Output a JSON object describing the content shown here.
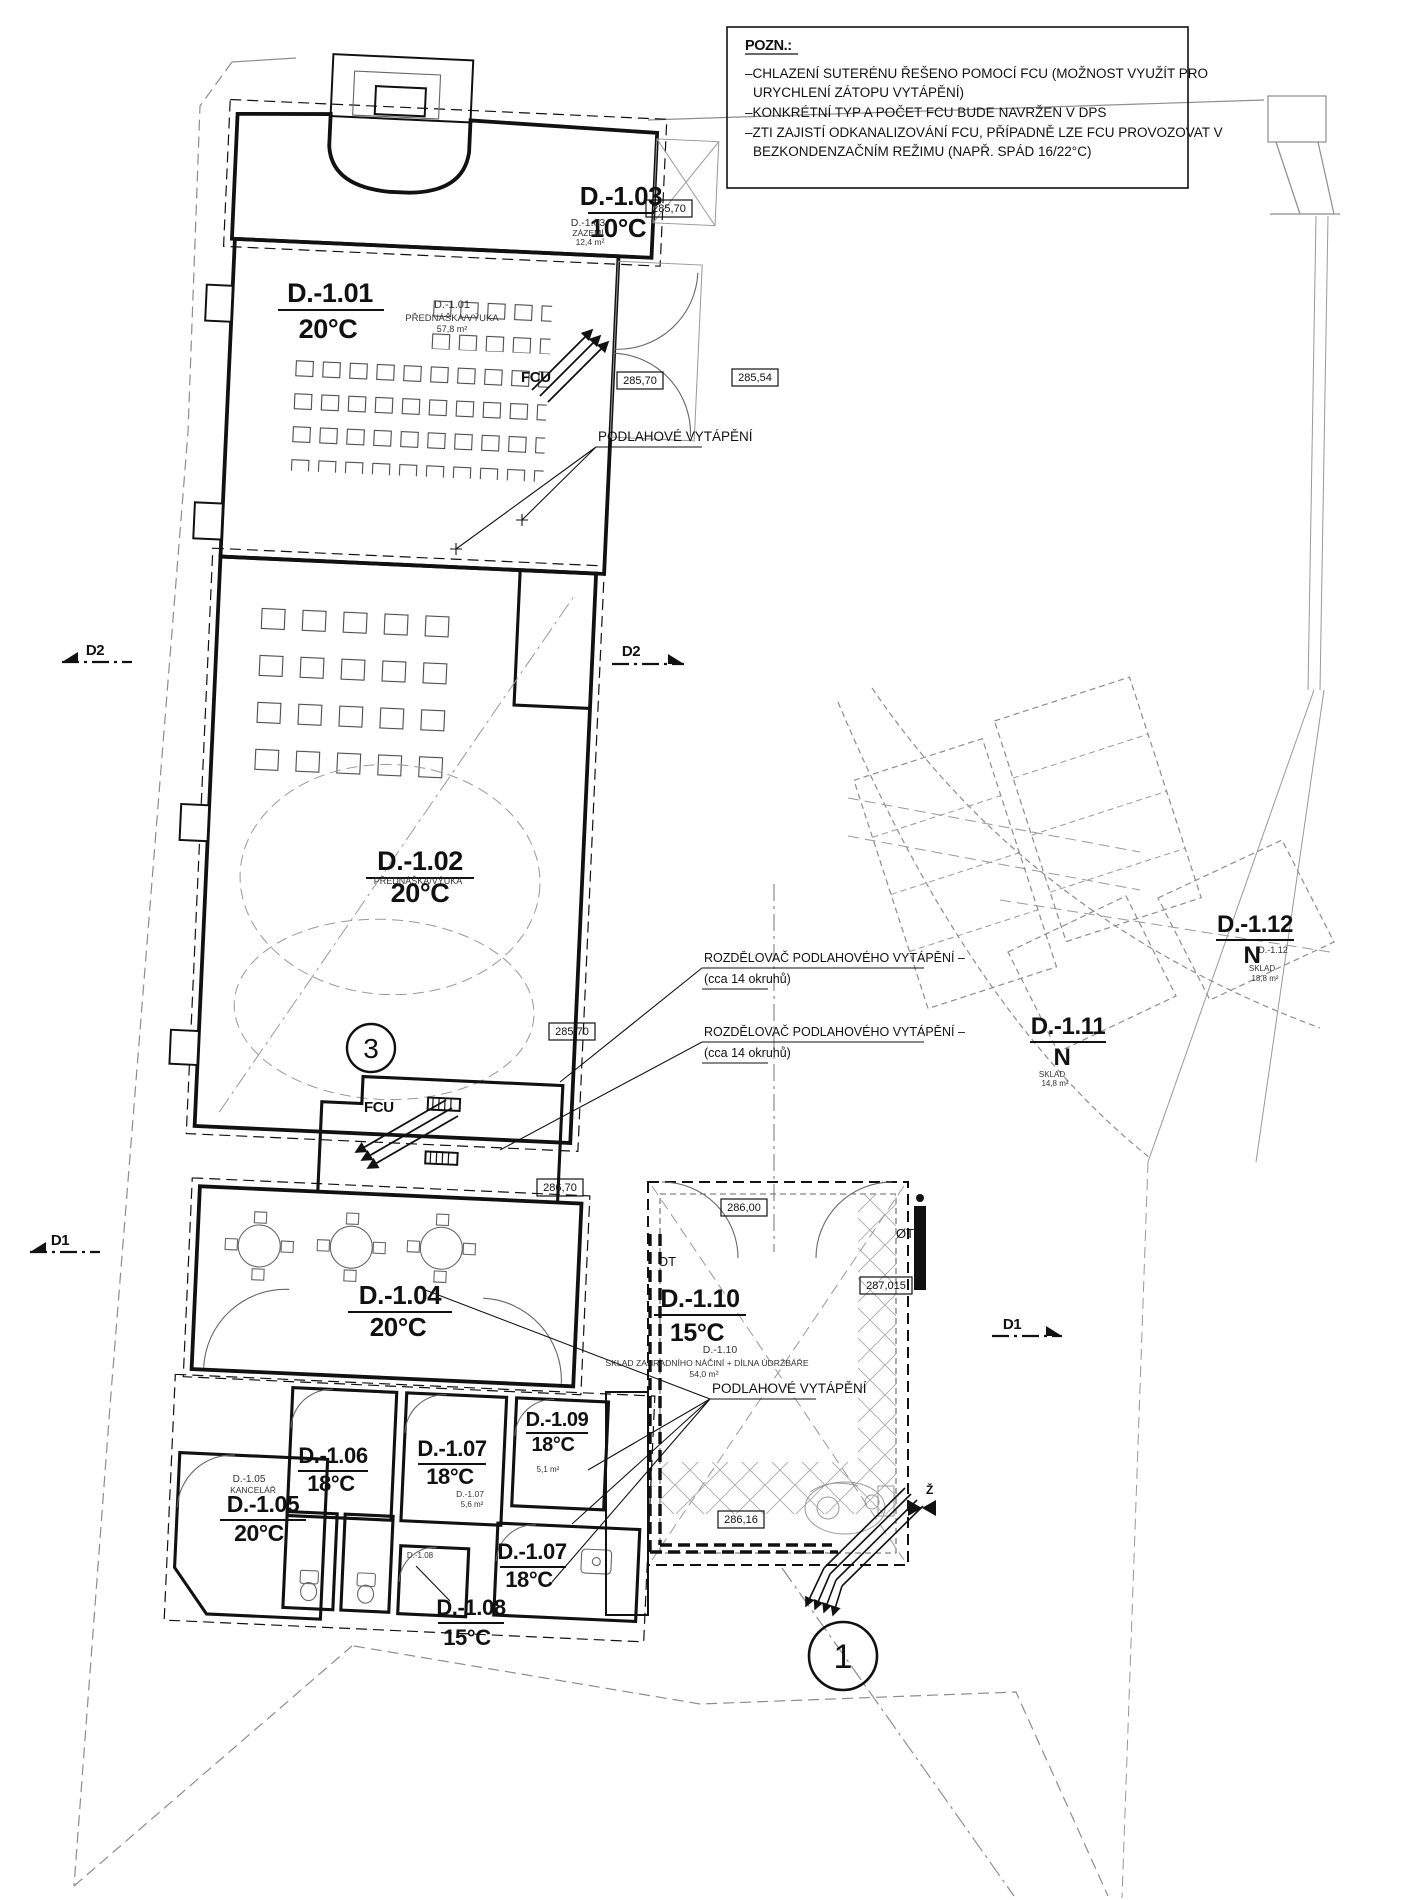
{
  "note": {
    "title": "POZN.:",
    "lines": [
      "–CHLAZENÍ SUTERÉNU ŘEŠENO POMOCÍ FCU (MOŽNOST VYUŽÍT PRO",
      "URYCHLENÍ ZÁTOPU VYTÁPĚNÍ)",
      "–KONKRÉTNÍ TYP A POČET FCU BUDE NAVRŽEN V DPS",
      "–ZTI ZAJISTÍ ODKANALIZOVÁNÍ FCU, PŘÍPADNĚ LZE FCU PROVOZOVAT V",
      "BEZKONDENZAČNÍM REŽIMU (NAPŘ. SPÁD 16/22°C)"
    ]
  },
  "rooms": {
    "d101": {
      "id": "D.-1.01",
      "temp": "20°C",
      "sub1": "D.-1.01",
      "sub2": "PŘEDNÁŠKA/VÝUKA",
      "sub3": "57,8 m²"
    },
    "d102": {
      "id": "D.-1.02",
      "temp": "20°C",
      "sub2": "PŘEDNÁŠKA/VÝUKA"
    },
    "d103": {
      "id": "D.-1.03",
      "temp": "10°C",
      "sub1": "D.-1.03",
      "sub2": "ZÁZEMÍ",
      "sub3": "12,4 m²"
    },
    "d104": {
      "id": "D.-1.04",
      "temp": "20°C"
    },
    "d105": {
      "id": "D.-1.05",
      "temp": "20°C",
      "sub1": "D.-1.05",
      "sub2": "KANCELÁŘ"
    },
    "d106": {
      "id": "D.-1.06",
      "temp": "18°C"
    },
    "d107a": {
      "id": "D.-1.07",
      "temp": "18°C",
      "sub1": "D.-1.07",
      "sub3": "5,6 m²"
    },
    "d108": {
      "id": "D.-1.08",
      "temp": "15°C",
      "sub1": "D.-1.08"
    },
    "d109": {
      "id": "D.-1.09",
      "temp": "18°C",
      "sub3": "5,1 m²"
    },
    "d107b": {
      "id": "D.-1.07",
      "temp": "18°C"
    },
    "d110": {
      "id": "D.-1.10",
      "temp": "15°C",
      "sub1": "D.-1.10",
      "sub2": "SKLAD ZAHRADNÍHO NÁČINÍ + DÍLNA ÚDRŽBÁŘE",
      "sub3": "54,0 m²"
    },
    "d111": {
      "id": "D.-1.11",
      "vent": "N",
      "sub2": "SKLAD",
      "sub3": "14,8 m²"
    },
    "d112": {
      "id": "D.-1.12",
      "vent": "N",
      "sub1": "D.-1.12",
      "sub2": "SKLAD",
      "sub3": "18,8 m²"
    }
  },
  "annotations": {
    "floor_heating": "PODLAHOVÉ VYTÁPĚNÍ",
    "manifold_line1": "ROZDĚLOVAČ PODLAHOVÉHO VYTÁPĚNÍ –",
    "manifold_line2": "(cca 14 okruhů)",
    "fcu": "FCU",
    "ot": "OT",
    "ot_crossed": "ØT",
    "z_valve": "Ž",
    "section_d1": "D1",
    "section_d2": "D2",
    "detail_circle_1": "1",
    "detail_circle_3": "3"
  },
  "elevations": {
    "e1": "285,70",
    "e2": "285,70",
    "e3": "285,54",
    "e4": "285,70",
    "e5": "286,70",
    "e6": "286,00",
    "e7": "287,015",
    "e8": "286,16"
  },
  "colors": {
    "ink": "#111111",
    "light_line": "#8d8d8d"
  }
}
